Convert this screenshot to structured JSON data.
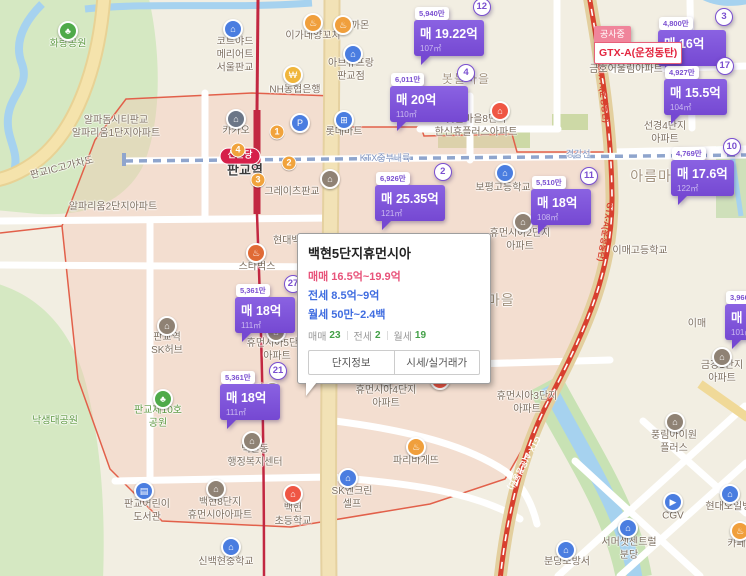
{
  "construction": {
    "tab": "공사중",
    "text": "GTX-A(운정동탄)"
  },
  "popup": {
    "title": "백현5단지휴먼시아",
    "lines": [
      {
        "text": "매매 16.5억~19.9억"
      },
      {
        "text": "전세 8.5억~9억"
      },
      {
        "text": "월세 50만~2.4백"
      }
    ],
    "counts": [
      {
        "label": "매매",
        "value": "23"
      },
      {
        "label": "전세",
        "value": "2"
      },
      {
        "label": "월세",
        "value": "19"
      }
    ],
    "buttons": [
      "단지정보",
      "시세/실거래가"
    ]
  },
  "map": {
    "accent_colors": {
      "marker": "#7a4fd0",
      "rail_shinbundang": "#c22741",
      "gtx": "#d8402f",
      "boundary": "#e2604a",
      "park": "#5f9a43",
      "water": "#a6d2ef"
    },
    "labels": [
      {
        "t": "화랑공원",
        "x": 68,
        "y": 44,
        "cls": "park",
        "n": "label-hwarang-park"
      },
      {
        "t": "낙생대공원",
        "x": 55,
        "y": 421,
        "cls": "park",
        "n": "label-naksaengdae-park"
      },
      {
        "t": "판교제10호\n공원",
        "x": 158,
        "y": 417,
        "cls": "park",
        "n": "label-pangyo-park10"
      },
      {
        "t": "신분당",
        "x": 240,
        "y": 156,
        "cls": "pill-red",
        "n": "label-shinbundang-line"
      },
      {
        "t": "판교역",
        "x": 245,
        "y": 171,
        "cls": "station",
        "n": "label-pangyo-station"
      },
      {
        "t": "경강선",
        "x": 578,
        "y": 155,
        "cls": "rail",
        "n": "label-gyeonggang-line"
      },
      {
        "t": "KTX중부내륙",
        "x": 385,
        "y": 159,
        "cls": "rail",
        "n": "label-ktx-line"
      },
      {
        "t": "백현마을",
        "x": 252,
        "y": 390,
        "cls": "district",
        "n": "label-baekhyeon-village"
      },
      {
        "t": "백현마을",
        "x": 487,
        "y": 300,
        "cls": "district",
        "n": "label-baekhyeon-village"
      },
      {
        "t": "아름마을",
        "x": 658,
        "y": 176,
        "cls": "district",
        "n": "label-areum-village"
      },
      {
        "t": "봇들마을",
        "x": 466,
        "y": 80,
        "cls": "district-sm",
        "n": "label-botdeul-village"
      },
      {
        "t": "현대백화점",
        "x": 273,
        "y": 241,
        "a": "l",
        "n": "label-hyundai-dept"
      },
      {
        "t": "코트야드\n메리어트\n서울판교",
        "x": 235,
        "y": 55,
        "n": "label-courtyard-marriott"
      },
      {
        "t": "이가네양꼬치",
        "x": 313,
        "y": 36,
        "n": "label-restaurant"
      },
      {
        "t": "까몬",
        "x": 360,
        "y": 26,
        "n": "label-kkamon"
      },
      {
        "t": "아브뉴프랑\n판교점",
        "x": 351,
        "y": 70,
        "n": "label-avenuefran"
      },
      {
        "t": "NH농협은행",
        "x": 295,
        "y": 90,
        "n": "label-nh-bank"
      },
      {
        "t": "카카오",
        "x": 236,
        "y": 131,
        "n": "label-kakao"
      },
      {
        "t": "롯데마트",
        "x": 344,
        "y": 132,
        "n": "label-lottemart"
      },
      {
        "t": "그레이츠판교",
        "x": 292,
        "y": 192,
        "n": "label-greits-pangyo"
      },
      {
        "t": "알파돔시티판교\n알파리움1단지아파트",
        "x": 116,
        "y": 127,
        "n": "label-alparium1"
      },
      {
        "t": "알파리움2단지아파트",
        "x": 113,
        "y": 207,
        "n": "label-alparium2"
      },
      {
        "t": "판교IC고가차도",
        "x": 62,
        "y": 168,
        "rot": -14,
        "n": "label-pangyo-ic"
      },
      {
        "t": "봇들마을8단지\n한신휴플러스아파트",
        "x": 476,
        "y": 126,
        "n": "label-botdeul8"
      },
      {
        "t": "봇들마을9단지\n금호어울림아파트",
        "x": 626,
        "y": 63,
        "n": "label-botdeul9"
      },
      {
        "t": "선경4단지\n아파트",
        "x": 665,
        "y": 133,
        "n": "label-seonkyeong4"
      },
      {
        "t": "스타벅스",
        "x": 257,
        "y": 267,
        "n": "label-starbucks"
      },
      {
        "t": "판교역\nSK허브",
        "x": 167,
        "y": 344,
        "n": "label-sk-hub"
      },
      {
        "t": "휴먼시아5단지\n아파트",
        "x": 277,
        "y": 350,
        "n": "label-humansia5"
      },
      {
        "t": "휴먼시아4단지\n아파트",
        "x": 386,
        "y": 397,
        "n": "label-humansia4"
      },
      {
        "t": "휴먼시아3단지\n아파트",
        "x": 527,
        "y": 403,
        "n": "label-humansia3"
      },
      {
        "t": "휴먼시아2단지\n아파트",
        "x": 520,
        "y": 240,
        "n": "label-humansia2"
      },
      {
        "t": "보평고등학교",
        "x": 503,
        "y": 188,
        "n": "label-bopyeong-hs"
      },
      {
        "t": "백현동\n행정복지센터",
        "x": 255,
        "y": 456,
        "n": "label-baekhyeon-center"
      },
      {
        "t": "판교어린이\n도서관",
        "x": 147,
        "y": 511,
        "n": "label-children-library"
      },
      {
        "t": "백현8단지\n휴먼시아아파트",
        "x": 220,
        "y": 509,
        "n": "label-baekhyeon8"
      },
      {
        "t": "신백현중학교",
        "x": 226,
        "y": 562,
        "n": "label-sinbaekhyeon-ms"
      },
      {
        "t": "백현\n초등학교",
        "x": 293,
        "y": 515,
        "n": "label-baekhyeon-es"
      },
      {
        "t": "SK엔크린\n셀프",
        "x": 352,
        "y": 498,
        "n": "label-sk-gas"
      },
      {
        "t": "파리바게뜨",
        "x": 416,
        "y": 461,
        "n": "label-paris-baguette"
      },
      {
        "t": "이매고등학교",
        "x": 640,
        "y": 251,
        "n": "label-imae-hs"
      },
      {
        "t": "이매",
        "x": 697,
        "y": 324,
        "n": "label-imae"
      },
      {
        "t": "금강1단지\n아파트",
        "x": 722,
        "y": 372,
        "n": "label-geumgang1"
      },
      {
        "t": "풍림아이원\n플러스",
        "x": 674,
        "y": 442,
        "n": "label-pungrim"
      },
      {
        "t": "CGV",
        "x": 673,
        "y": 516,
        "n": "label-cgv"
      },
      {
        "t": "현대오일뱅크",
        "x": 733,
        "y": 507,
        "n": "label-hyundai-oilbank"
      },
      {
        "t": "카페굿",
        "x": 741,
        "y": 544,
        "n": "label-cafe"
      },
      {
        "t": "서머셋센트럴\n분당",
        "x": 629,
        "y": 549,
        "n": "label-somerset"
      },
      {
        "t": "분당소방서",
        "x": 567,
        "y": 562,
        "n": "label-bundang-fire-station"
      }
    ],
    "pois": [
      {
        "g": "♣",
        "c": "#4faa4a",
        "x": 68,
        "y": 31,
        "n": "park-tree"
      },
      {
        "g": "♣",
        "c": "#4faa4a",
        "x": 163,
        "y": 399,
        "n": "park-tree"
      },
      {
        "g": "⌂",
        "c": "#4a7de0",
        "x": 233,
        "y": 29,
        "n": "hotel"
      },
      {
        "g": "♨",
        "c": "#f09f3c",
        "x": 313,
        "y": 23,
        "n": "restaurant"
      },
      {
        "g": "♨",
        "c": "#f09f3c",
        "x": 343,
        "y": 25,
        "n": "restaurant"
      },
      {
        "g": "⌂",
        "c": "#4a7de0",
        "x": 353,
        "y": 54,
        "n": "shopping-mall"
      },
      {
        "g": "₩",
        "c": "#f0b63c",
        "x": 293,
        "y": 75,
        "n": "bank"
      },
      {
        "g": "⌂",
        "c": "#6b7687",
        "x": 236,
        "y": 119,
        "n": "kakao-office"
      },
      {
        "g": "P",
        "c": "#4a7de0",
        "x": 300,
        "y": 123,
        "n": "parking"
      },
      {
        "g": "⊞",
        "c": "#4a7de0",
        "x": 344,
        "y": 120,
        "n": "mart"
      },
      {
        "g": "⌂",
        "c": "#8f8274",
        "x": 330,
        "y": 179,
        "n": "building"
      },
      {
        "g": "♨",
        "c": "#e06a35",
        "x": 256,
        "y": 253,
        "n": "starbucks"
      },
      {
        "g": "⌂",
        "c": "#ef5644",
        "x": 500,
        "y": 111,
        "n": "school-red"
      },
      {
        "g": "⌂",
        "c": "#4a7de0",
        "x": 505,
        "y": 173,
        "n": "high-school"
      },
      {
        "g": "⌂",
        "c": "#8f8274",
        "x": 523,
        "y": 222,
        "n": "apartment"
      },
      {
        "g": "⌂",
        "c": "#8f8274",
        "x": 276,
        "y": 332,
        "n": "apartment"
      },
      {
        "g": "⌂",
        "c": "#8f8274",
        "x": 167,
        "y": 326,
        "n": "office-building"
      },
      {
        "g": "⌂",
        "c": "#8f8274",
        "x": 252,
        "y": 441,
        "n": "government-office"
      },
      {
        "g": "⌂",
        "c": "#8f8274",
        "x": 386,
        "y": 375,
        "n": "apartment"
      },
      {
        "g": "⌂",
        "c": "#ef5644",
        "x": 440,
        "y": 380,
        "n": "school-red"
      },
      {
        "g": "▤",
        "c": "#4a7de0",
        "x": 144,
        "y": 491,
        "n": "library"
      },
      {
        "g": "⌂",
        "c": "#8f8274",
        "x": 216,
        "y": 489,
        "n": "apartment"
      },
      {
        "g": "⌂",
        "c": "#4a7de0",
        "x": 231,
        "y": 547,
        "n": "middle-school"
      },
      {
        "g": "⌂",
        "c": "#ef5644",
        "x": 293,
        "y": 494,
        "n": "elementary-school"
      },
      {
        "g": "⌂",
        "c": "#4a7de0",
        "x": 348,
        "y": 478,
        "n": "gas-station"
      },
      {
        "g": "♨",
        "c": "#f09f3c",
        "x": 416,
        "y": 447,
        "n": "bakery"
      },
      {
        "g": "⌂",
        "c": "#8f8274",
        "x": 722,
        "y": 357,
        "n": "apartment"
      },
      {
        "g": "⌂",
        "c": "#8f8274",
        "x": 675,
        "y": 422,
        "n": "apartment"
      },
      {
        "g": "▶",
        "c": "#4a7de0",
        "x": 673,
        "y": 502,
        "n": "cinema"
      },
      {
        "g": "⌂",
        "c": "#4a7de0",
        "x": 730,
        "y": 494,
        "n": "gas-station"
      },
      {
        "g": "♨",
        "c": "#f09f3c",
        "x": 740,
        "y": 531,
        "n": "cafe"
      },
      {
        "g": "⌂",
        "c": "#4a7de0",
        "x": 628,
        "y": 528,
        "n": "hotel"
      },
      {
        "g": "⌂",
        "c": "#4a7de0",
        "x": 566,
        "y": 550,
        "n": "fire-station"
      }
    ],
    "exits": [
      {
        "n": "1",
        "x": 277,
        "y": 132
      },
      {
        "n": "4",
        "x": 238,
        "y": 150
      },
      {
        "n": "2",
        "x": 289,
        "y": 163
      },
      {
        "n": "3",
        "x": 258,
        "y": 180
      }
    ],
    "rail_texts": [
      {
        "t": "GTX-A(운정동탄)",
        "x": 603,
        "y": 93,
        "rot": 84
      },
      {
        "t": "GTX-A(운정동탄)",
        "x": 605,
        "y": 232,
        "rot": 99
      },
      {
        "t": "GTX-A(운정동탄)",
        "x": 524,
        "y": 463,
        "rot": 119,
        "white": true
      }
    ],
    "markers": [
      {
        "badge": "12",
        "unit": "5,940만",
        "price": "매 19.22억",
        "area": "107㎡",
        "x": 414,
        "y": 3
      },
      {
        "badge": "4",
        "unit": "6,011만",
        "price": "매 20억",
        "area": "110㎡",
        "x": 390,
        "y": 69,
        "w": 66
      },
      {
        "badge": "2",
        "unit": "6,926만",
        "price": "매 25.35억",
        "area": "121㎡",
        "x": 375,
        "y": 168
      },
      {
        "badge": "11",
        "unit": "5,510만",
        "price": "매 18억",
        "area": "108㎡",
        "x": 531,
        "y": 172
      },
      {
        "badge": "3",
        "unit": "4,800만",
        "price": "매 16억",
        "area": "",
        "x": 658,
        "y": 13,
        "w": 56
      },
      {
        "badge": "17",
        "unit": "4,927만",
        "price": "매 15.5억",
        "area": "104㎡",
        "x": 664,
        "y": 62
      },
      {
        "badge": "10",
        "unit": "4,769만",
        "price": "매 17.6억",
        "area": "122㎡",
        "x": 671,
        "y": 143
      },
      {
        "badge": "27",
        "unit": "5,361만",
        "price": "매 18억",
        "area": "111㎡",
        "x": 235,
        "y": 280
      },
      {
        "badge": "21",
        "unit": "5,361만",
        "price": "매 18억",
        "area": "111㎡",
        "x": 220,
        "y": 367
      },
      {
        "badge": "",
        "unit": "3,960만",
        "price": "매 1",
        "area": "101㎡",
        "x": 725,
        "y": 287
      }
    ]
  }
}
